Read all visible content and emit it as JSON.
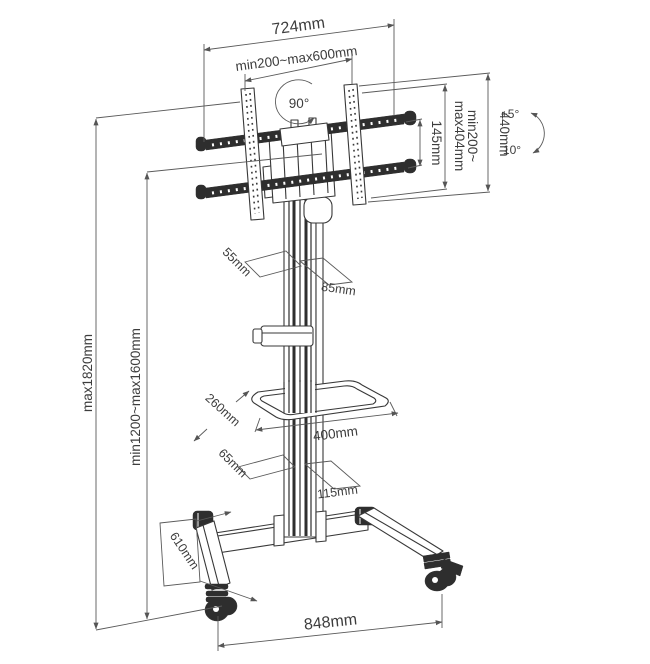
{
  "diagram_title": "tv-cart-dimension-diagram",
  "colors": {
    "ink": "#383838",
    "dim_line": "#5a5a5a",
    "fill_dark": "#2e2e2e",
    "background": "#ffffff"
  },
  "labels": {
    "top_width": "724mm",
    "vesa_width_range": "min200~max600mm",
    "swivel": "90°",
    "crossbar_spacing": "145mm",
    "vesa_height_line1": "min200~",
    "vesa_height_line2": "max404mm",
    "plate_height": "440mm",
    "tilt_up": "+5°",
    "tilt_down": "-10°",
    "column_depth": "55mm",
    "column_width": "85mm",
    "overall_height": "max1820mm",
    "screen_center_height": "min1200~max1600mm",
    "shelf_depth": "260mm",
    "shelf_width": "400mm",
    "lower_column_depth": "65mm",
    "lower_column_width": "115mm",
    "leg_depth": "610mm",
    "base_width": "848mm"
  }
}
